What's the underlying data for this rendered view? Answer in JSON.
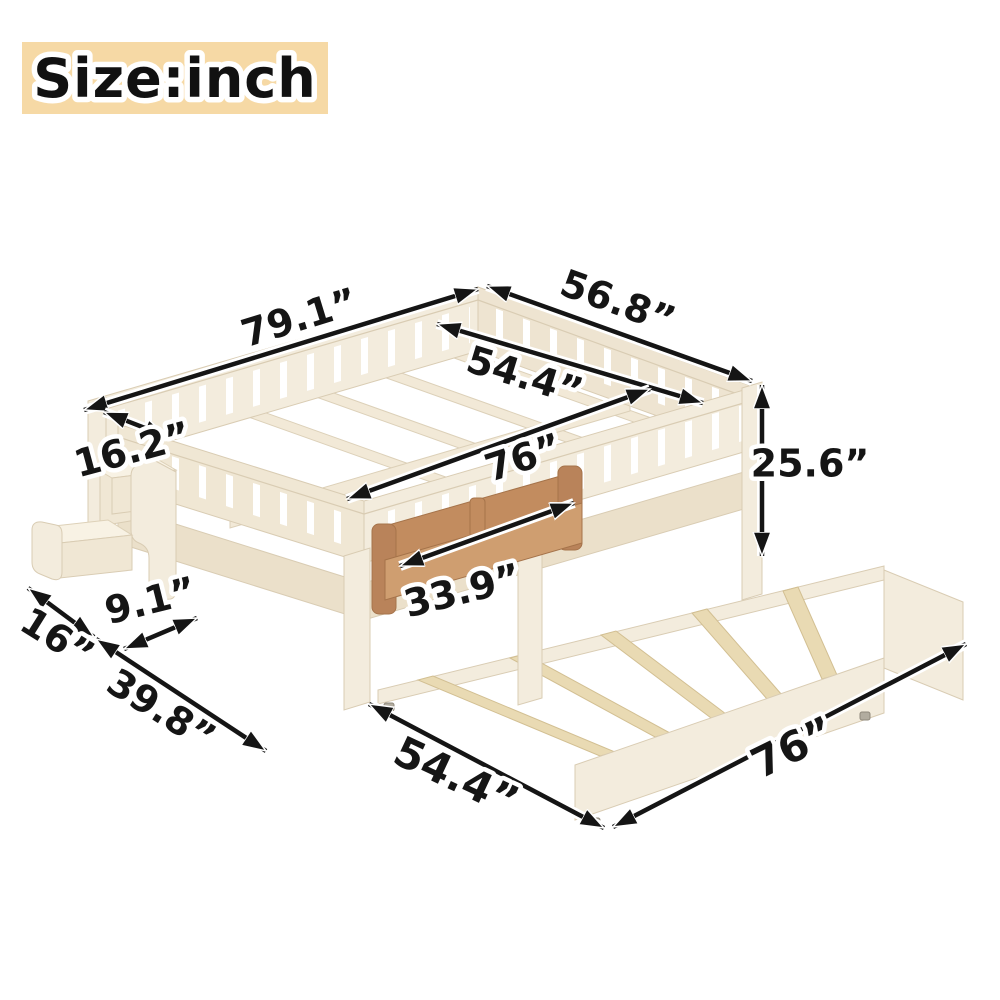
{
  "header": {
    "size_label": "Size:inch"
  },
  "palette": {
    "background": "#ffffff",
    "label_badge_bg": "#f6d9a5",
    "wood_cream": "#f3ecdd",
    "wood_cream_dark": "#eee4d1",
    "trundle_slat_tan": "#e9dab3",
    "shelf_brown": "#c28c5f",
    "arrow_black": "#151515",
    "label_text": "#151515",
    "label_outline": "#ffffff"
  },
  "dimensions": {
    "overall_length": "79.1”",
    "overall_width": "56.8”",
    "inner_width": "54.4”",
    "inner_length": "76”",
    "head_rail_depth": "16.2”",
    "overall_height": "25.6”",
    "shelf_length": "33.9”",
    "step_depth": "9.1”",
    "step_width": "16”",
    "step_run": "39.8”",
    "trundle_width": "54.4”",
    "trundle_length": "76”"
  }
}
